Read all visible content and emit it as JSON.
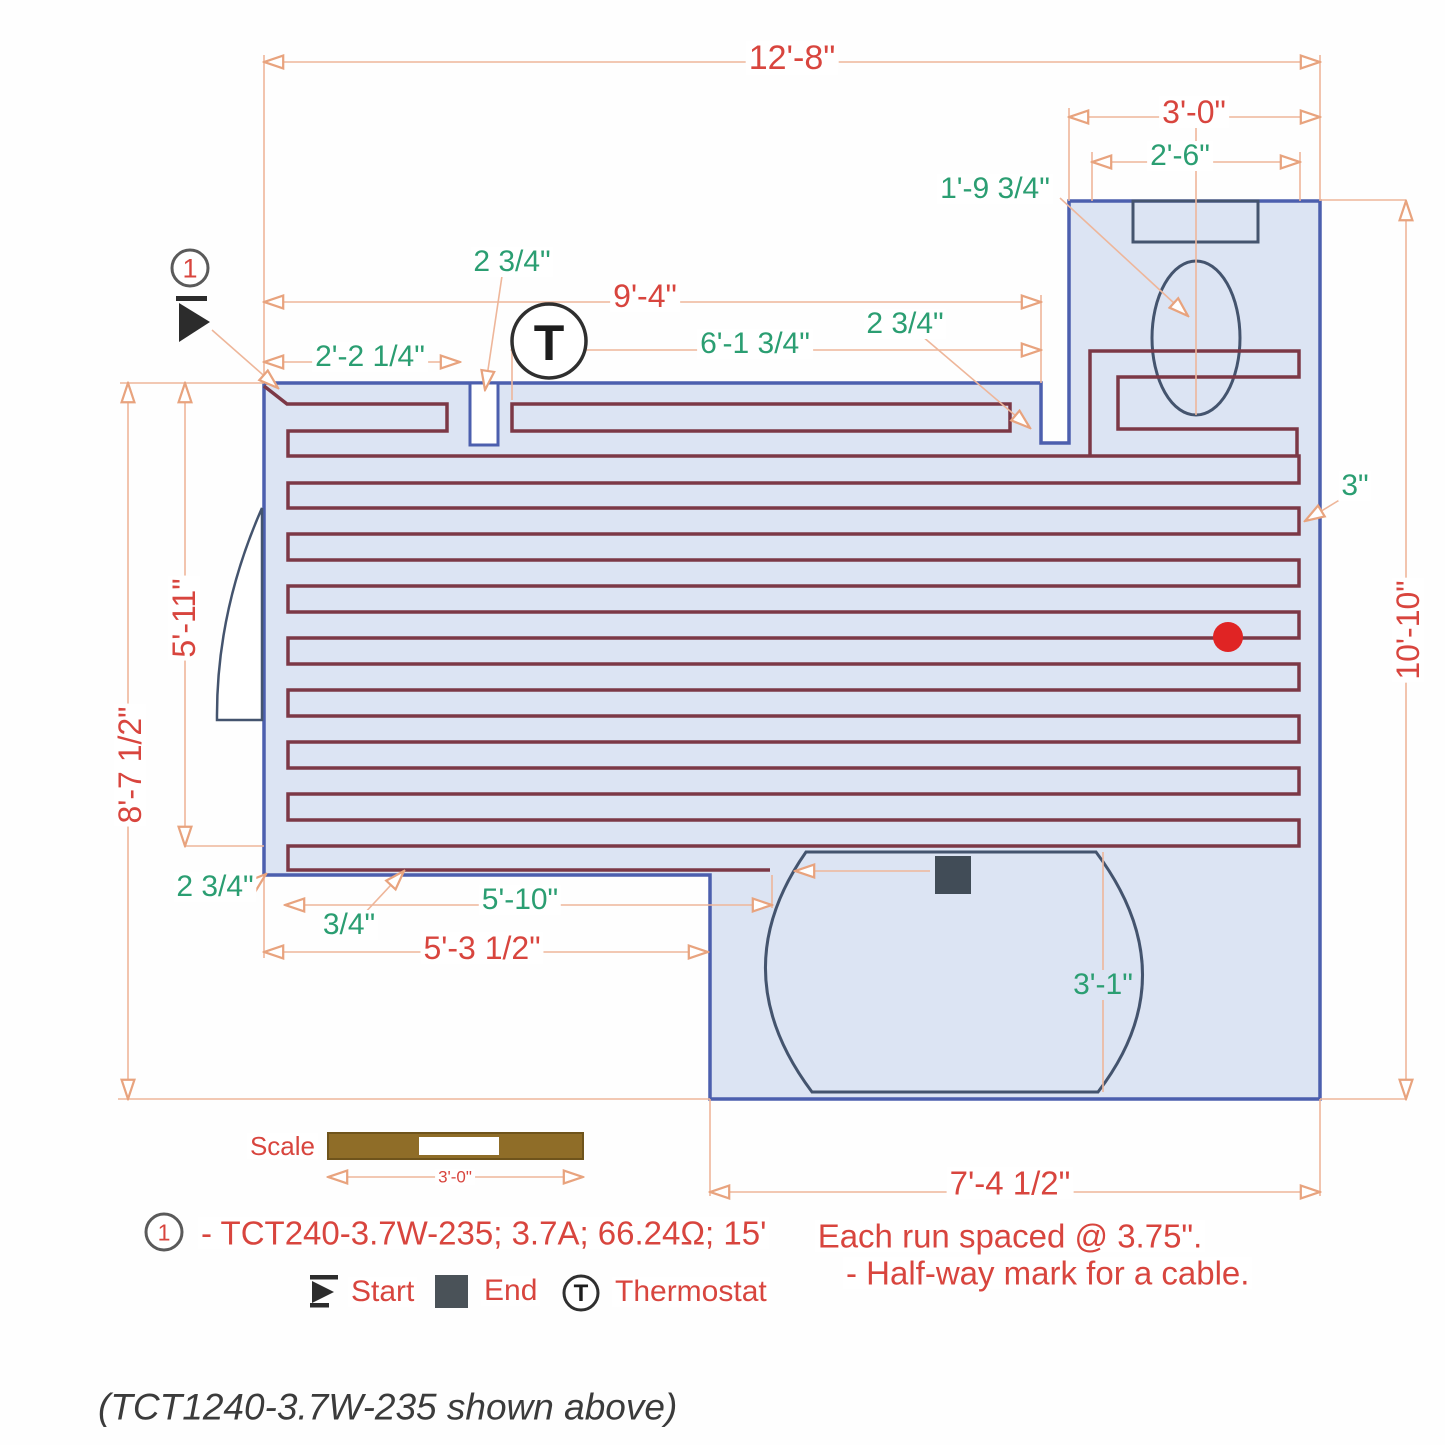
{
  "colors": {
    "red": "#d8453e",
    "green": "#2b9e72",
    "wall": "#4c5fae",
    "room": "#dce4f3",
    "cable": "#7c3846",
    "peach": "#eeb69a",
    "navy": "#44546e",
    "brown": "#8f6d28",
    "dot": "#e02424",
    "ink": "#333333"
  },
  "callout": {
    "number": "1"
  },
  "thermostat_letter": "T",
  "dims": {
    "w_total": "12'-8\"",
    "alcove_w": "3'-0\"",
    "alcove_inner_w": "2'-6\"",
    "toilet_offset": "1'-9 3/4\"",
    "top_run": "9'-4\"",
    "gap_a": "2 3/4\"",
    "start_offset": "2'-2 1/4\"",
    "mid_run": "6'-1 3/4\"",
    "gap_b": "2 3/4\"",
    "h_left": "8'-7 1/2\"",
    "h_cable": "5'-11\"",
    "h_right": "10'-10\"",
    "edge_gap": "3\"",
    "gap_c": "2 3/4\"",
    "gap_d": "3/4\"",
    "bottom_run": "5'-10\"",
    "bottom_left": "5'-3 1/2\"",
    "tub_h": "3'-1\"",
    "tub_w": "7'-4 1/2\""
  },
  "scale": {
    "label": "Scale",
    "value": "3'-0\""
  },
  "legend": {
    "product": "- TCT240-3.7W-235; 3.7A; 66.24Ω; 15'",
    "start": "Start",
    "end": "End",
    "thermostat": "Thermostat"
  },
  "notes": {
    "spacing": "Each run spaced @ 3.75\".",
    "halfway": "- Half-way mark for a cable."
  },
  "caption": "(TCT1240-3.7W-235 shown above)"
}
